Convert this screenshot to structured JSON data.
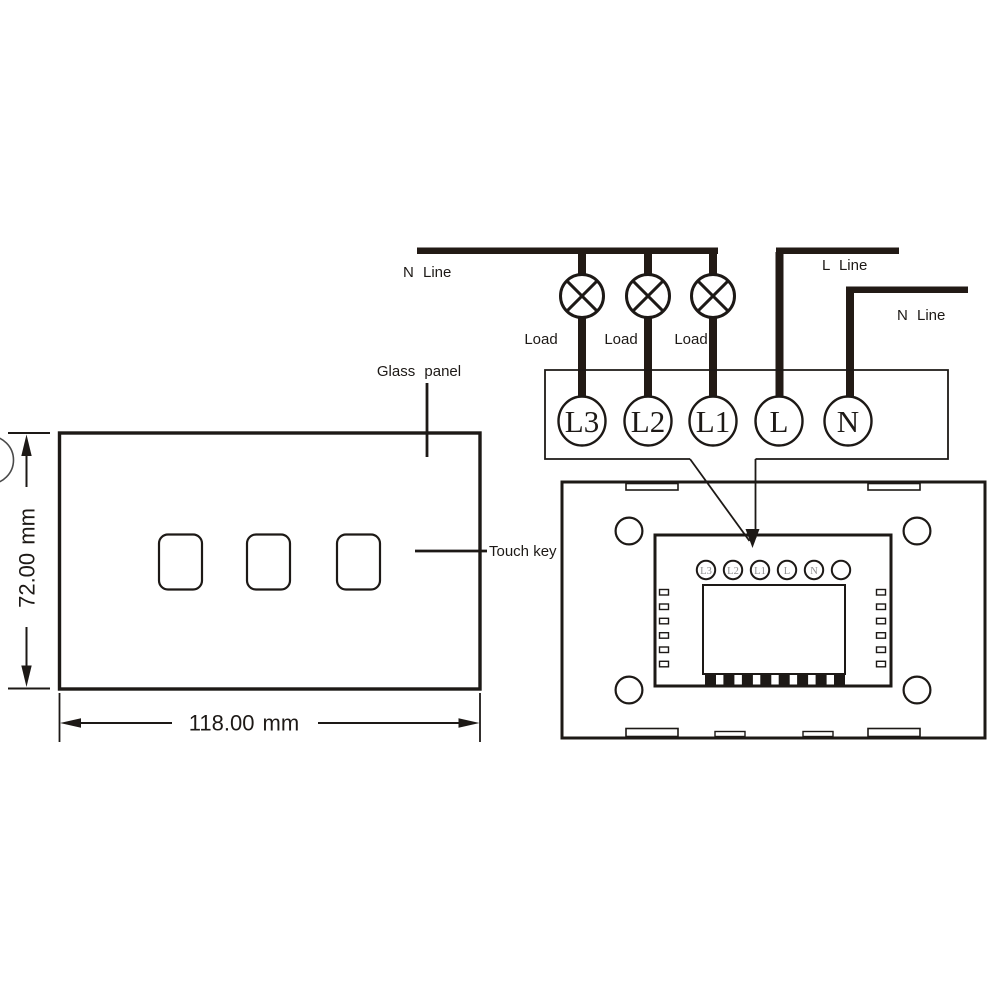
{
  "colors": {
    "background": "#ffffff",
    "line_ink": "#1d1916",
    "thick_wire": "#221a15",
    "module_terminal_text": "#8e8e8e"
  },
  "icons": {
    "lamp": "lamp-load-circle-cross-icon",
    "dimension_arrow": "solid-triangle-arrow",
    "callout_arrow": "down-arrowhead"
  },
  "front_view": {
    "glass_panel_label": "Glass panel",
    "touch_key_label": "Touch key",
    "width_dimension": "118.00 mm",
    "height_dimension": "72.00 mm",
    "touch_key_count": 3
  },
  "wiring": {
    "neutral_bus_label": "N Line",
    "live_line_label": "L Line",
    "neutral_line_label": "N Line",
    "load_labels": [
      "Load",
      "Load",
      "Load"
    ],
    "terminal_labels": [
      "L3",
      "L2",
      "L1",
      "L",
      "N"
    ]
  },
  "back_view": {
    "terminal_labels": [
      "L3",
      "L2",
      "L1",
      "L",
      "N",
      ""
    ],
    "mounting_hole_count": 4,
    "connector_pin_count": 8,
    "side_slot_count_per_side": 6
  }
}
